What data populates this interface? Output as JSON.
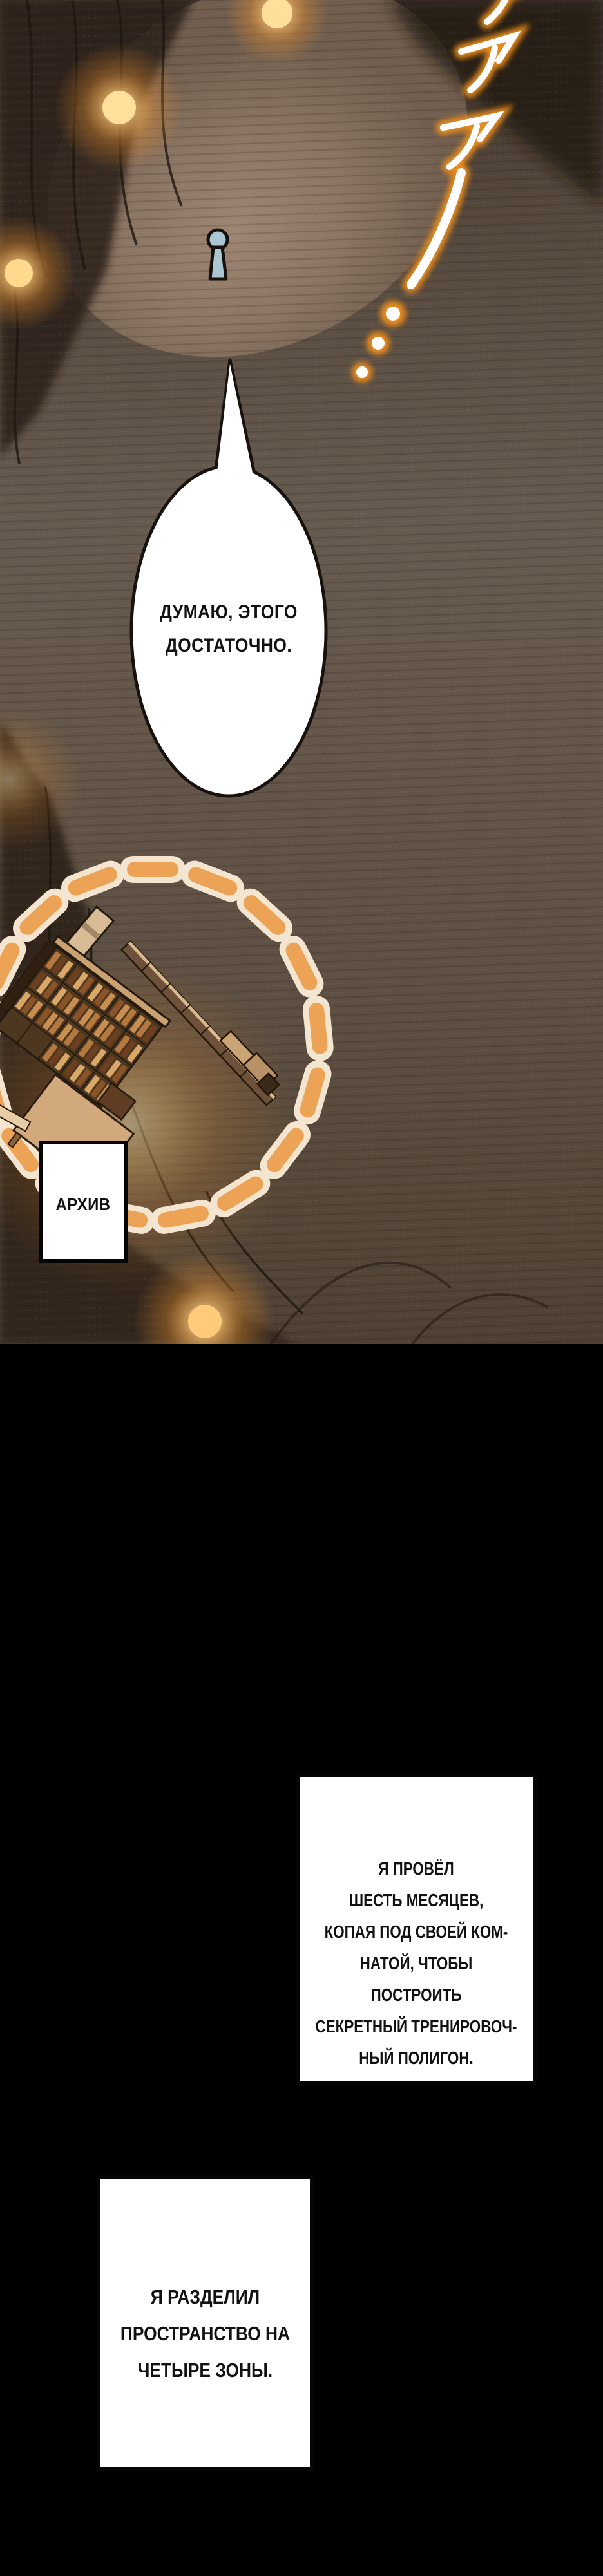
{
  "panel": {
    "speech_bubble": {
      "text": "ДУМАЮ, ЭТОГО\nДОСТАТОЧНО."
    },
    "archive_label": "АРХИВ",
    "scream_sfx": "アアア!...",
    "colors": {
      "glow_orange": "#f49631",
      "dash_cream": "#f3e5cf",
      "dash_orange": "#eda356",
      "keyhole_blue": "#a9c6d2",
      "wood_brown": "#4e371f",
      "gutter_black": "#000000"
    }
  },
  "captions": [
    {
      "text": "Я ПРОВЁЛ\nШЕСТЬ МЕСЯЦЕВ,\nКОПАЯ ПОД СВОЕЙ КОМ-\nНАТОЙ, ЧТОБЫ ПОСТРОИТЬ\nСЕКРЕТНЫЙ ТРЕНИРОВОЧ-\nНЫЙ ПОЛИГОН."
    },
    {
      "text": "Я РАЗДЕЛИЛ\nПРОСТРАНСТВО НА\nЧЕТЫРЕ ЗОНЫ."
    }
  ]
}
